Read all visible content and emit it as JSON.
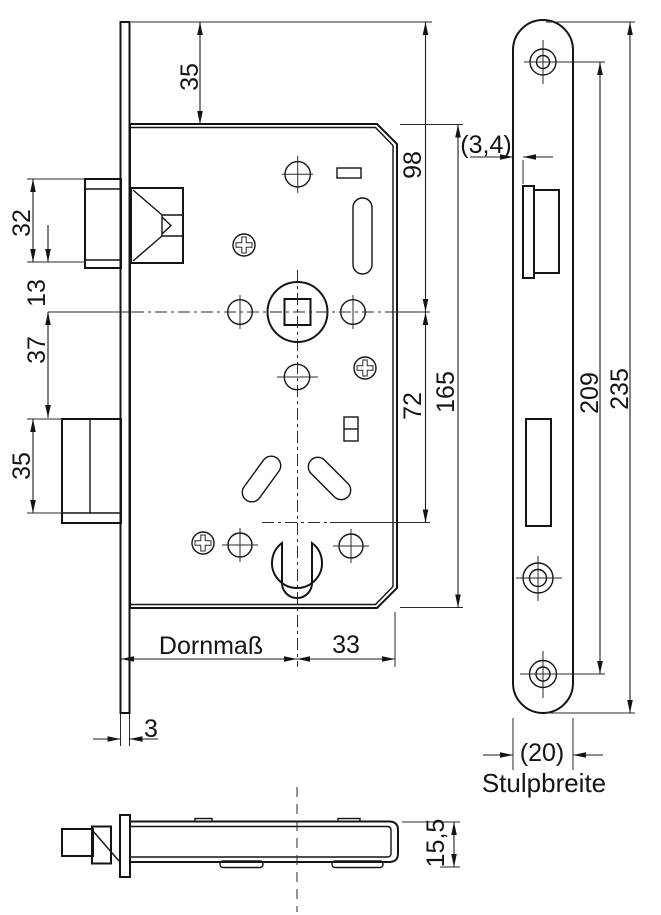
{
  "drawing": {
    "title": "mortise-lock-technical-drawing",
    "colors": {
      "line": "#141414",
      "background": "#ffffff"
    },
    "dimensions": {
      "plate_top_to_case_top": "35",
      "plate_top_to_follower": "98",
      "latch_height": "32",
      "latch_to_follower": "13",
      "follower_to_deadbolt": "37",
      "deadbolt_height": "35",
      "follower_to_cylinder": "72",
      "case_height": "165",
      "latch_offset": "(3,4)",
      "backset_label": "Dornmaß",
      "cylinder_to_case_edge": "33",
      "faceplate_thickness": "3",
      "screw_spacing": "209",
      "faceplate_length": "235",
      "faceplate_width": "(20)",
      "faceplate_width_label": "Stulpbreite",
      "case_depth": "15,5"
    }
  }
}
